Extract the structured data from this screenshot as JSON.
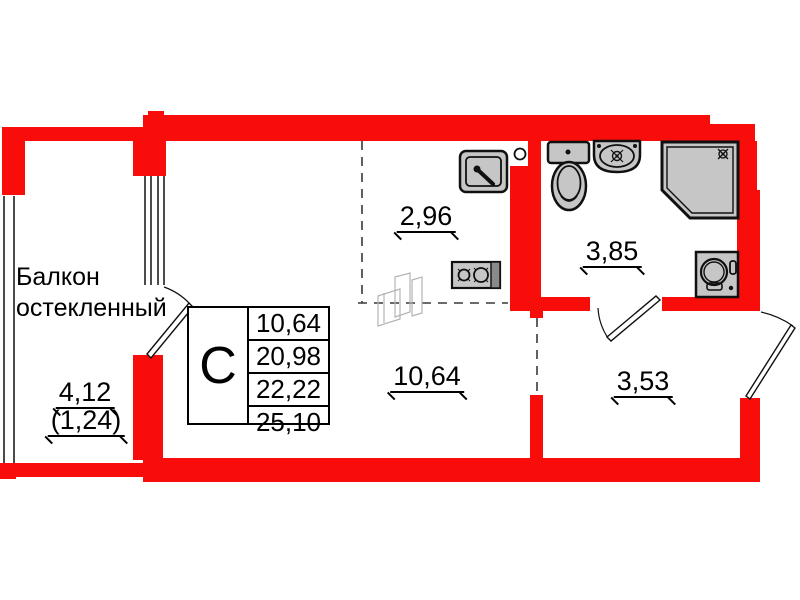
{
  "colors": {
    "wall_red": "#f90d0b",
    "fixture_gray": "#c6c6c6",
    "sketch_gray": "#b3b3b3",
    "line_black": "#101010"
  },
  "balcony": {
    "name_line1": "Балкон",
    "name_line2": "остекленный",
    "area": "4,12",
    "area_reduced": "(1,24)"
  },
  "rooms": {
    "kitchen_area": "2,96",
    "bathroom_area": "3,85",
    "living_area": "10,64",
    "hall_area": "3,53"
  },
  "info_table": {
    "type_letter": "С",
    "rows": [
      "10,64",
      "20,98",
      "22,22",
      "25,10"
    ]
  }
}
